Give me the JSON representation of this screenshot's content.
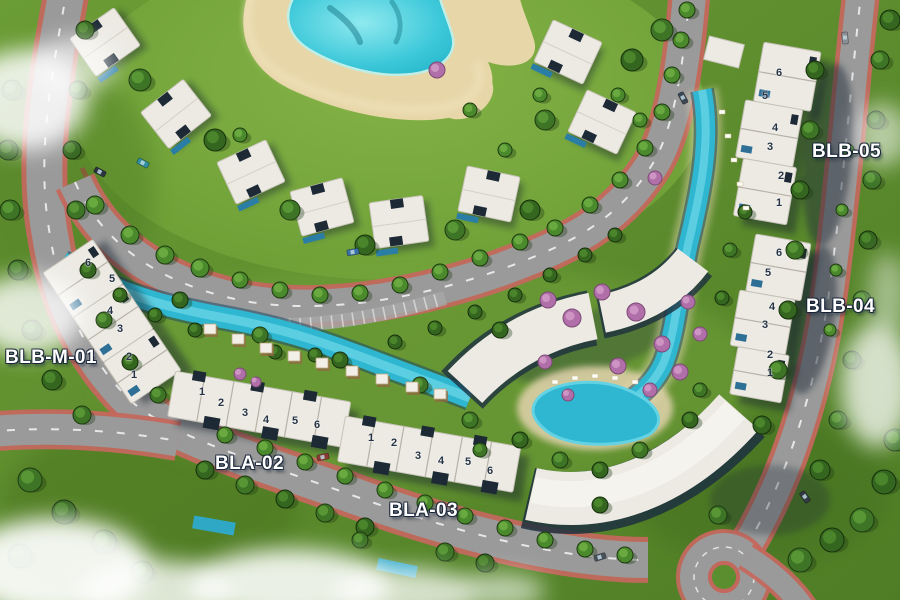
{
  "labels": {
    "blb05": "BLB-05",
    "blb04": "BLB-04",
    "blbm01": "BLB-M-01",
    "bla02": "BLA-02",
    "bla03": "BLA-03"
  },
  "clusters": [
    {
      "id": "blb-05",
      "label": "BLB-05",
      "units": [
        {
          "n": "6",
          "x": 779,
          "y": 73
        },
        {
          "n": "5",
          "x": 765,
          "y": 96
        },
        {
          "n": "4",
          "x": 775,
          "y": 128
        },
        {
          "n": "3",
          "x": 770,
          "y": 147
        },
        {
          "n": "2",
          "x": 781,
          "y": 176
        },
        {
          "n": "1",
          "x": 779,
          "y": 203
        }
      ]
    },
    {
      "id": "blb-04",
      "label": "BLB-04",
      "units": [
        {
          "n": "6",
          "x": 779,
          "y": 253
        },
        {
          "n": "5",
          "x": 768,
          "y": 273
        },
        {
          "n": "4",
          "x": 772,
          "y": 307
        },
        {
          "n": "3",
          "x": 765,
          "y": 325
        },
        {
          "n": "2",
          "x": 770,
          "y": 355
        },
        {
          "n": "1",
          "x": 770,
          "y": 373
        }
      ]
    },
    {
      "id": "blb-m-01",
      "label": "BLB-M-01",
      "units": [
        {
          "n": "6",
          "x": 88,
          "y": 263
        },
        {
          "n": "5",
          "x": 112,
          "y": 279
        },
        {
          "n": "4",
          "x": 110,
          "y": 311
        },
        {
          "n": "3",
          "x": 120,
          "y": 329
        },
        {
          "n": "2",
          "x": 129,
          "y": 357
        },
        {
          "n": "1",
          "x": 134,
          "y": 375
        }
      ]
    },
    {
      "id": "bla-02",
      "label": "BLA-02",
      "units": [
        {
          "n": "1",
          "x": 202,
          "y": 392
        },
        {
          "n": "2",
          "x": 221,
          "y": 403
        },
        {
          "n": "3",
          "x": 245,
          "y": 413
        },
        {
          "n": "4",
          "x": 266,
          "y": 420
        },
        {
          "n": "5",
          "x": 295,
          "y": 421
        },
        {
          "n": "6",
          "x": 317,
          "y": 425
        }
      ]
    },
    {
      "id": "bla-03",
      "label": "BLA-03",
      "units": [
        {
          "n": "1",
          "x": 371,
          "y": 438
        },
        {
          "n": "2",
          "x": 394,
          "y": 443
        },
        {
          "n": "3",
          "x": 418,
          "y": 456
        },
        {
          "n": "4",
          "x": 441,
          "y": 461
        },
        {
          "n": "5",
          "x": 468,
          "y": 462
        },
        {
          "n": "6",
          "x": 490,
          "y": 471
        }
      ]
    }
  ],
  "colors": {
    "grass": "#5f8f33",
    "lagoon": "#2fc6d8",
    "pool": "#2fb7d2",
    "sand": "#e7d6a8",
    "road": "#9a9a9a",
    "road_edge_red": "#c4685e",
    "roof_white": "#eceae3",
    "shadow_navy": "#1b2a3a",
    "flowering_tree": "#b06fa8",
    "label_text": "#ffffff"
  }
}
